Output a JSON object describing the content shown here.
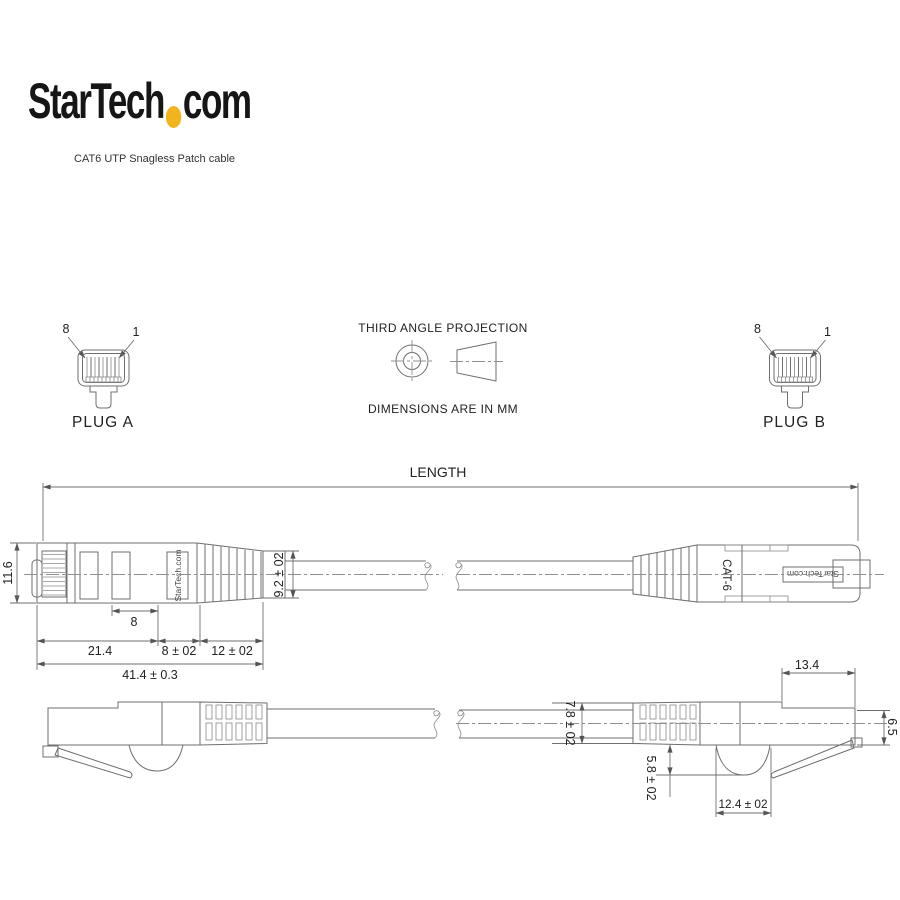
{
  "header": {
    "logo_part1": "StarTech",
    "logo_part2": "com",
    "subtitle": "CAT6 UTP Snagless Patch cable"
  },
  "projection": {
    "title": "THIRD ANGLE PROJECTION",
    "note": "DIMENSIONS ARE IN MM"
  },
  "plug_a": {
    "label": "PLUG A",
    "pin_left": "8",
    "pin_right": "1"
  },
  "plug_b": {
    "label": "PLUG B",
    "pin_left": "8",
    "pin_right": "1"
  },
  "length_dimension": {
    "label": "LENGTH"
  },
  "side_view": {
    "plug_marking": "StarTech.com",
    "height": "11.6",
    "inner_width": "8",
    "dim_body": "21.4",
    "dim_mid": "8 ± 02",
    "dim_boot": "12 ± 02",
    "dim_overall": "41.4 ± 0.3",
    "boot_diameter": "9.2 ± 02"
  },
  "top_view": {
    "cat_label": "CAT-6",
    "plug_marking": "StarTech.com"
  },
  "bottom_view": {
    "front_length": "13.4",
    "cable_diameter": "7.8 ± 02",
    "latch_depth": "5.8 ± 02",
    "hump_width": "12.4 ± 02",
    "end_height": "6.5"
  },
  "colors": {
    "logo_dot": "#F2B41E",
    "drawing_line": "#6f6f6f",
    "text": "#222222"
  }
}
